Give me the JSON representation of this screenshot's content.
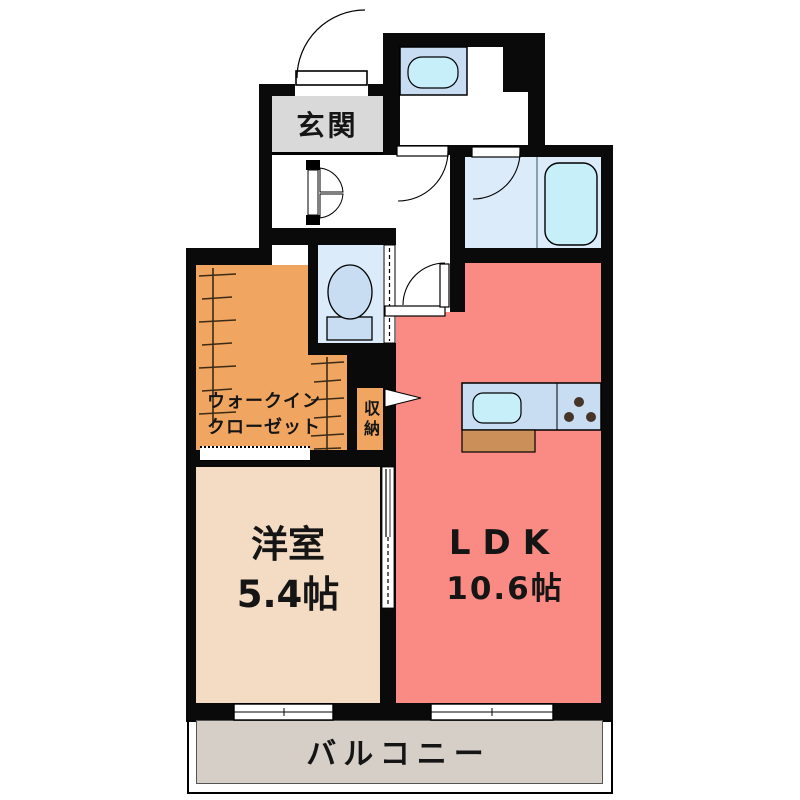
{
  "plan": {
    "rooms": {
      "genkan": {
        "label": "玄関"
      },
      "wic": {
        "label_line1": "ウォークイン",
        "label_line2": "クローゼット"
      },
      "storage": {
        "label": "収納"
      },
      "bedroom": {
        "name": "洋室",
        "size": "5.4帖"
      },
      "ldk": {
        "name": "LDK",
        "size": "10.6帖"
      },
      "balcony": {
        "label": "バルコニー"
      }
    },
    "fixtures": [
      "entrance-door",
      "shoe-cabinet",
      "washbasin",
      "bathtub",
      "toilet",
      "kitchen-sink",
      "gas-stove",
      "hanger-rail",
      "sliding-door",
      "storage-arrow",
      "balcony-window"
    ]
  },
  "colors": {
    "wall": "#0a0a0a",
    "genkan_floor": "#d9d9d9",
    "closet_orange": "#f0a661",
    "bedroom_floor": "#f3dcc3",
    "ldk_floor": "#fa8a84",
    "balcony_floor": "#d6cfc8",
    "wet_floor": "#dcebfa",
    "fixture_fill": "#c9ddf2",
    "fixture_water": "#c6effa",
    "counter_brown": "#cb9059",
    "burner_dark": "#473428"
  }
}
